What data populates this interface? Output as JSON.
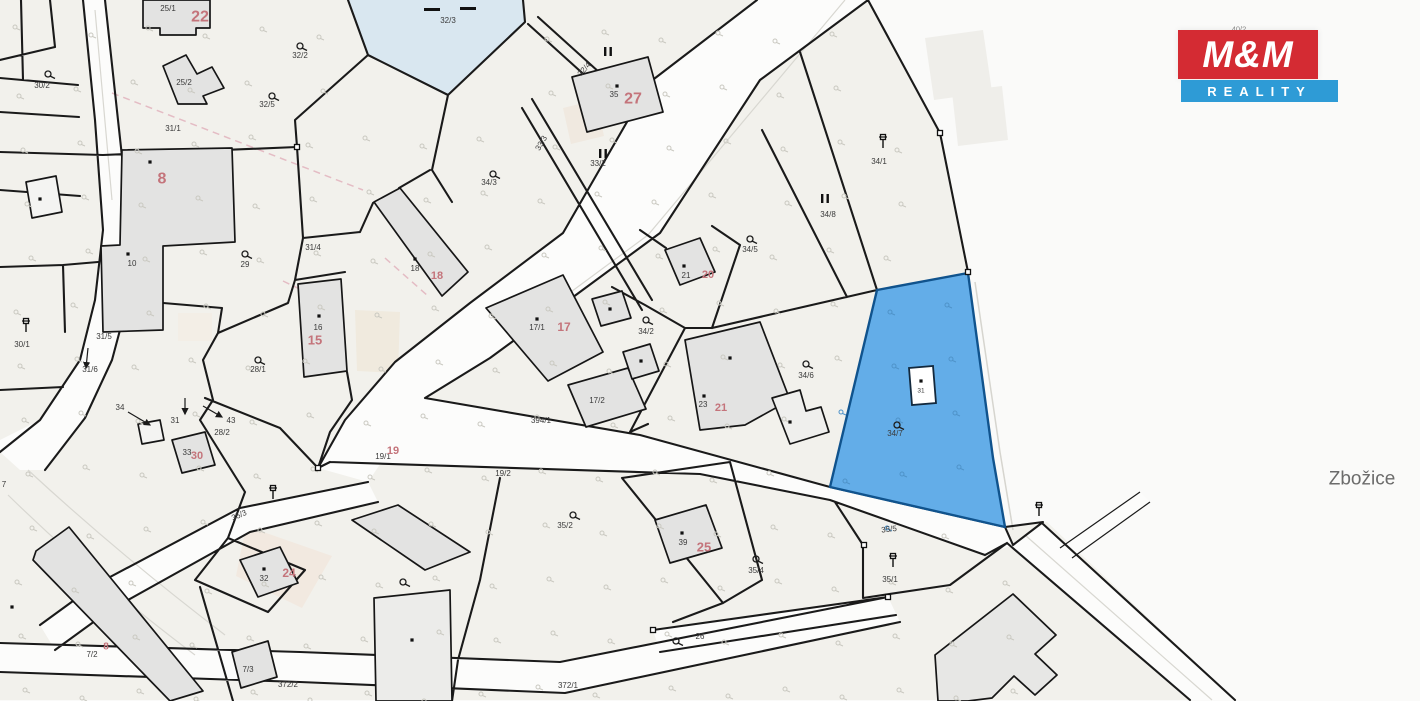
{
  "logo": {
    "top": "M&M",
    "bottom": "REALITY",
    "red": "#d42b33",
    "blue": "#2e9bd6"
  },
  "colors": {
    "outside": "#fafaf9",
    "cream": "#f2f1ec",
    "road": "#fcfcfb",
    "line": "#1a1a1a",
    "building": "#e3e3e2",
    "buildingStroke": "#161616",
    "whiteBuilding": "#f4f4f2",
    "blueParcel": "#63ade8",
    "blueStroke": "#10538d",
    "pond": "#d9e7f0",
    "red": "#c4747b",
    "small": "#3a3a3a",
    "grass": "#cac9c1",
    "grassBlue": "#4f93c9",
    "faint": "#ecebe7",
    "beige": "#f2e9e0",
    "pink": "#e4bcc4",
    "gray": "#8a8a8a",
    "place": "#6b6b6b"
  },
  "map": {
    "highlighted_parcel": {
      "number": "34/7",
      "building_number": "31"
    },
    "place_name": "Zbožice",
    "labels": [
      {
        "n": "25-1",
        "t": "25/1",
        "x": 168,
        "y": 8,
        "c": "small"
      },
      {
        "n": "30-2",
        "t": "30/2",
        "x": 42,
        "y": 85,
        "c": "small"
      },
      {
        "n": "32-2",
        "t": "32/2",
        "x": 300,
        "y": 55,
        "c": "small"
      },
      {
        "n": "32-5",
        "t": "32/5",
        "x": 267,
        "y": 104,
        "c": "small"
      },
      {
        "n": "31-1",
        "t": "31/1",
        "x": 173,
        "y": 128,
        "c": "small"
      },
      {
        "n": "25-2",
        "t": "25/2",
        "x": 184,
        "y": 82,
        "c": "small"
      },
      {
        "n": "32-3",
        "t": "32/3",
        "x": 448,
        "y": 20,
        "c": "small"
      },
      {
        "n": "32-4",
        "t": "32/4",
        "x": 584,
        "y": 69,
        "c": "small",
        "r": -48
      },
      {
        "n": "b35",
        "t": "35",
        "x": 614,
        "y": 94,
        "c": "small"
      },
      {
        "n": "33-2",
        "t": "33/2",
        "x": 598,
        "y": 163,
        "c": "small"
      },
      {
        "n": "33-3",
        "t": "33/3",
        "x": 541,
        "y": 143,
        "c": "small",
        "r": -60
      },
      {
        "n": "34-3",
        "t": "34/3",
        "x": 489,
        "y": 182,
        "c": "small"
      },
      {
        "n": "34-1",
        "t": "34/1",
        "x": 879,
        "y": 161,
        "c": "small"
      },
      {
        "n": "34-8",
        "t": "34/8",
        "x": 828,
        "y": 214,
        "c": "small"
      },
      {
        "n": "34-5",
        "t": "34/5",
        "x": 750,
        "y": 249,
        "c": "small"
      },
      {
        "n": "b10",
        "t": "10",
        "x": 132,
        "y": 263,
        "c": "small"
      },
      {
        "n": "p29",
        "t": "29",
        "x": 245,
        "y": 264,
        "c": "small"
      },
      {
        "n": "31-4",
        "t": "31/4",
        "x": 313,
        "y": 247,
        "c": "small"
      },
      {
        "n": "b16",
        "t": "16",
        "x": 318,
        "y": 327,
        "c": "small"
      },
      {
        "n": "b18",
        "t": "18",
        "x": 415,
        "y": 268,
        "c": "small"
      },
      {
        "n": "17-1",
        "t": "17/1",
        "x": 537,
        "y": 327,
        "c": "small"
      },
      {
        "n": "34-2",
        "t": "34/2",
        "x": 646,
        "y": 331,
        "c": "small"
      },
      {
        "n": "b21",
        "t": "21",
        "x": 686,
        "y": 275,
        "c": "small"
      },
      {
        "n": "30-1",
        "t": "30/1",
        "x": 22,
        "y": 344,
        "c": "small"
      },
      {
        "n": "31-5",
        "t": "31/5",
        "x": 104,
        "y": 336,
        "c": "small"
      },
      {
        "n": "31-6",
        "t": "31/6",
        "x": 90,
        "y": 369,
        "c": "small"
      },
      {
        "n": "28-1",
        "t": "28/1",
        "x": 258,
        "y": 369,
        "c": "small"
      },
      {
        "n": "p34",
        "t": "34",
        "x": 120,
        "y": 407,
        "c": "small"
      },
      {
        "n": "p31",
        "t": "31",
        "x": 175,
        "y": 420,
        "c": "small"
      },
      {
        "n": "p43",
        "t": "43",
        "x": 231,
        "y": 420,
        "c": "small"
      },
      {
        "n": "28-2",
        "t": "28/2",
        "x": 222,
        "y": 432,
        "c": "small"
      },
      {
        "n": "b33",
        "t": "33",
        "x": 187,
        "y": 452,
        "c": "small"
      },
      {
        "n": "17-2",
        "t": "17/2",
        "x": 597,
        "y": 400,
        "c": "small"
      },
      {
        "n": "b23",
        "t": "23",
        "x": 703,
        "y": 404,
        "c": "small"
      },
      {
        "n": "34-6",
        "t": "34/6",
        "x": 806,
        "y": 375,
        "c": "small"
      },
      {
        "n": "19-1",
        "t": "19/1",
        "x": 383,
        "y": 456,
        "c": "small"
      },
      {
        "n": "19-2",
        "t": "19/2",
        "x": 503,
        "y": 473,
        "c": "small"
      },
      {
        "n": "34-7",
        "t": "34/7",
        "x": 895,
        "y": 433,
        "c": "small"
      },
      {
        "n": "b31-blue",
        "t": "31",
        "x": 921,
        "y": 390,
        "c": "small",
        "s": 6.5
      },
      {
        "n": "35-2",
        "t": "35/2",
        "x": 565,
        "y": 525,
        "c": "small"
      },
      {
        "n": "35-3",
        "t": "35/3",
        "x": 239,
        "y": 515,
        "c": "small",
        "r": -23
      },
      {
        "n": "35-4",
        "t": "35/4",
        "x": 756,
        "y": 570,
        "c": "small"
      },
      {
        "n": "35-1",
        "t": "35/1",
        "x": 890,
        "y": 579,
        "c": "small"
      },
      {
        "n": "b39",
        "t": "39",
        "x": 683,
        "y": 542,
        "c": "small"
      },
      {
        "n": "p26",
        "t": "26",
        "x": 700,
        "y": 636,
        "c": "small"
      },
      {
        "n": "7-2",
        "t": "7/2",
        "x": 92,
        "y": 654,
        "c": "small"
      },
      {
        "n": "7-3",
        "t": "7/3",
        "x": 248,
        "y": 669,
        "c": "small"
      },
      {
        "n": "372-2",
        "t": "372/2",
        "x": 288,
        "y": 684,
        "c": "small"
      },
      {
        "n": "b32",
        "t": "32",
        "x": 264,
        "y": 578,
        "c": "small"
      },
      {
        "n": "p7",
        "t": "7",
        "x": 4,
        "y": 484,
        "c": "small"
      },
      {
        "n": "394-1",
        "t": "394/1",
        "x": 541,
        "y": 420,
        "c": "road"
      },
      {
        "n": "35-5",
        "t": "35/5",
        "x": 889,
        "y": 529,
        "c": "road",
        "r": -6
      },
      {
        "n": "372-1",
        "t": "372/1",
        "x": 568,
        "y": 685,
        "c": "road"
      },
      {
        "n": "40-2",
        "t": "40/2",
        "x": 1239,
        "y": 29,
        "c": "tiny"
      },
      {
        "n": "red-22",
        "t": "22",
        "x": 200,
        "y": 16,
        "c": "red",
        "s": 16
      },
      {
        "n": "red-8",
        "t": "8",
        "x": 162,
        "y": 178,
        "c": "red",
        "s": 16
      },
      {
        "n": "red-27",
        "t": "27",
        "x": 633,
        "y": 98,
        "c": "red",
        "s": 16
      },
      {
        "n": "red-18",
        "t": "18",
        "x": 437,
        "y": 275,
        "c": "red",
        "s": 11
      },
      {
        "n": "red-17",
        "t": "17",
        "x": 564,
        "y": 327,
        "c": "red",
        "s": 12
      },
      {
        "n": "red-15",
        "t": "15",
        "x": 315,
        "y": 340,
        "c": "red",
        "s": 13
      },
      {
        "n": "red-20",
        "t": "20",
        "x": 708,
        "y": 274,
        "c": "red",
        "s": 11
      },
      {
        "n": "red-21",
        "t": "21",
        "x": 721,
        "y": 407,
        "c": "red",
        "s": 11
      },
      {
        "n": "red-19",
        "t": "19",
        "x": 393,
        "y": 450,
        "c": "red",
        "s": 11
      },
      {
        "n": "red-30",
        "t": "30",
        "x": 197,
        "y": 455,
        "c": "red",
        "s": 11
      },
      {
        "n": "red-24",
        "t": "24",
        "x": 289,
        "y": 573,
        "c": "red",
        "s": 12
      },
      {
        "n": "red-25",
        "t": "25",
        "x": 704,
        "y": 547,
        "c": "red",
        "s": 13
      },
      {
        "n": "red-8b",
        "t": "8",
        "x": 106,
        "y": 646,
        "c": "red",
        "s": 10
      },
      {
        "n": "place",
        "t": "Zbožice",
        "x": 1362,
        "y": 478,
        "c": "place"
      }
    ],
    "trees": [
      [
        48,
        74
      ],
      [
        300,
        46
      ],
      [
        272,
        96
      ],
      [
        493,
        174
      ],
      [
        245,
        254
      ],
      [
        258,
        360
      ],
      [
        646,
        320
      ],
      [
        806,
        364
      ],
      [
        750,
        239
      ],
      [
        897,
        425
      ],
      [
        573,
        515
      ],
      [
        403,
        582
      ],
      [
        676,
        641
      ],
      [
        756,
        559
      ]
    ],
    "pins": [
      [
        26,
        332
      ],
      [
        883,
        148
      ],
      [
        273,
        499
      ],
      [
        893,
        567
      ],
      [
        1039,
        516
      ]
    ],
    "dots": [
      [
        617,
        86
      ],
      [
        415,
        259
      ],
      [
        150,
        162
      ],
      [
        128,
        254
      ],
      [
        40,
        199
      ],
      [
        319,
        316
      ],
      [
        537,
        319
      ],
      [
        610,
        309
      ],
      [
        641,
        361
      ],
      [
        684,
        266
      ],
      [
        730,
        358
      ],
      [
        704,
        396
      ],
      [
        790,
        422
      ],
      [
        921,
        381
      ],
      [
        264,
        569
      ],
      [
        682,
        533
      ],
      [
        412,
        640
      ],
      [
        12,
        607
      ]
    ],
    "ii_marks": [
      [
        608,
        51
      ],
      [
        603,
        153
      ],
      [
        825,
        198
      ]
    ],
    "nodes": [
      [
        940,
        133
      ],
      [
        968,
        272
      ],
      [
        297,
        147
      ],
      [
        888,
        597
      ],
      [
        653,
        630
      ],
      [
        864,
        545
      ],
      [
        318,
        468
      ]
    ],
    "arrows": [
      [
        88,
        348,
        86,
        368
      ],
      [
        128,
        412,
        150,
        425
      ],
      [
        185,
        398,
        185,
        414
      ],
      [
        203,
        406,
        222,
        417
      ]
    ],
    "dashes": [
      [
        424,
        8
      ],
      [
        460,
        7
      ]
    ]
  }
}
